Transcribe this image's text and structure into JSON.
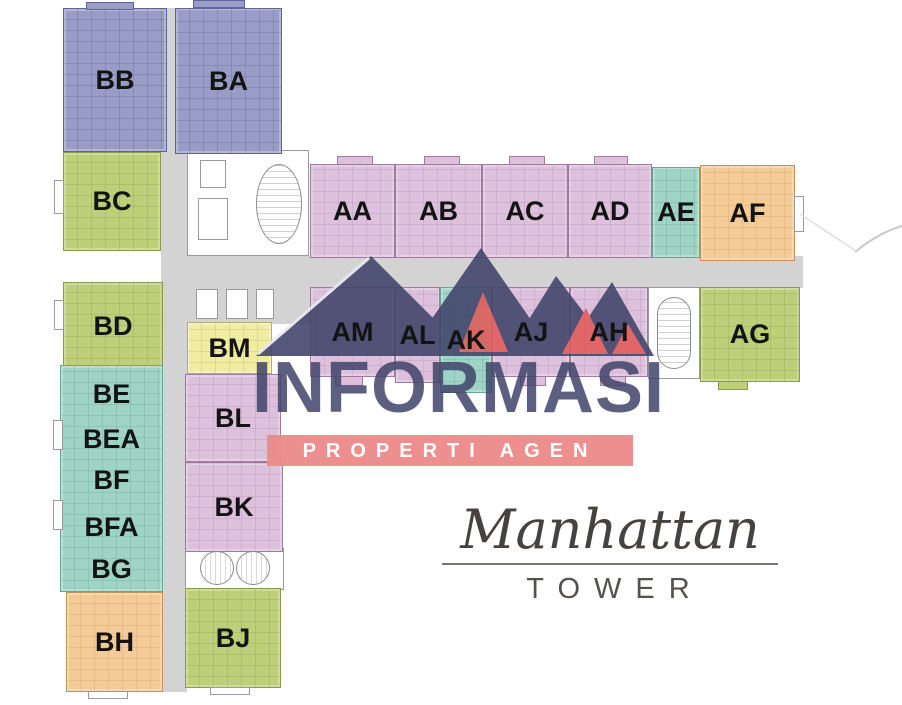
{
  "watermark": {
    "brand": "INFORMASI",
    "banner": "PROPERTI AGEN",
    "logo_navy": "#40436a",
    "logo_red": "#e15a5a",
    "banner_bg": "#ee8a8a"
  },
  "tower_sign": {
    "name": "Manhattan",
    "subtitle": "TOWER"
  },
  "palette": {
    "purple_unit": "#989cc6",
    "pink_unit": "#dcc0dc",
    "green_unit": "#bece79",
    "teal_unit": "#9ed3c5",
    "orange_unit": "#f4ca97",
    "yellow_unit": "#f0eda2",
    "corridor_gray": "#d3d3d3"
  },
  "units": {
    "bb": {
      "label": "BB"
    },
    "ba": {
      "label": "BA"
    },
    "bc": {
      "label": "BC"
    },
    "aa": {
      "label": "AA"
    },
    "ab": {
      "label": "AB"
    },
    "ac": {
      "label": "AC"
    },
    "ad": {
      "label": "AD"
    },
    "ae": {
      "label": "AE"
    },
    "af": {
      "label": "AF"
    },
    "am": {
      "label": "AM"
    },
    "al": {
      "label": "AL"
    },
    "ak": {
      "label": "AK"
    },
    "aj": {
      "label": "AJ"
    },
    "ah": {
      "label": "AH"
    },
    "ag": {
      "label": "AG"
    },
    "bd": {
      "label": "BD"
    },
    "bm": {
      "label": "BM"
    },
    "be": {
      "label": "BE"
    },
    "bea": {
      "label": "BEA"
    },
    "bf": {
      "label": "BF"
    },
    "bfa": {
      "label": "BFA"
    },
    "bg": {
      "label": "BG"
    },
    "bh": {
      "label": "BH"
    },
    "bl": {
      "label": "BL"
    },
    "bk": {
      "label": "BK"
    },
    "bj": {
      "label": "BJ"
    }
  }
}
